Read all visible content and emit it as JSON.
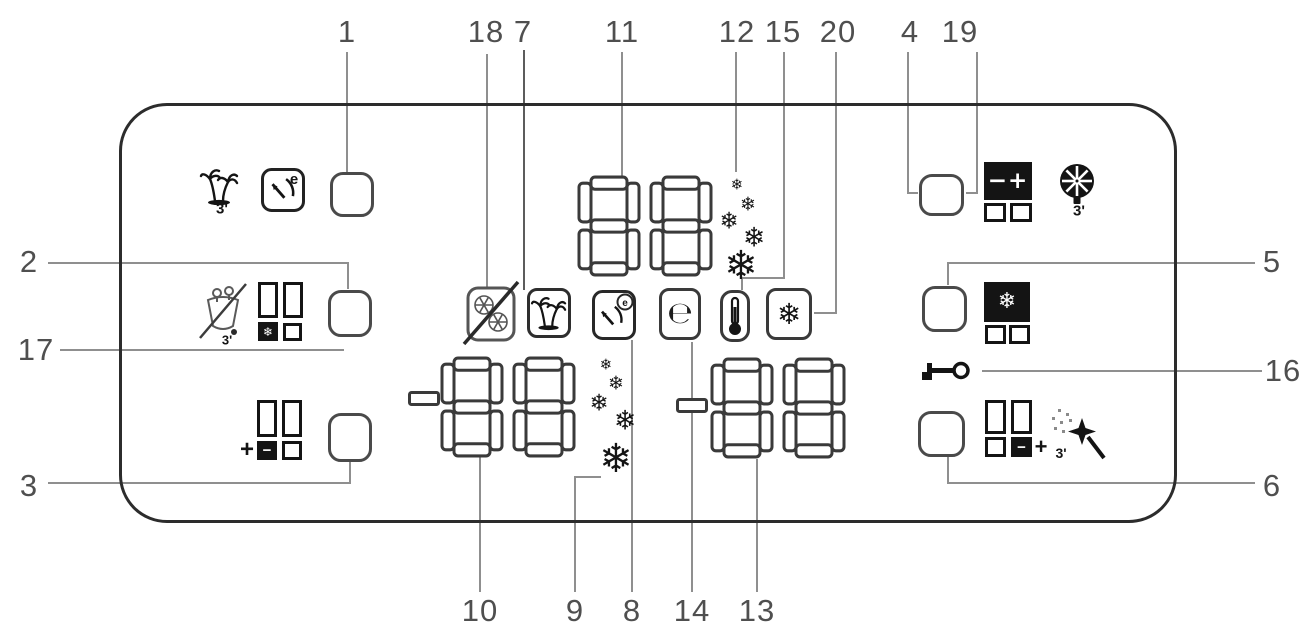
{
  "diagram": {
    "type": "appliance-control-panel-callout-diagram",
    "colors": {
      "background": "#ffffff",
      "panel_border": "#2c2c2c",
      "leader_line": "#8f8f8f",
      "number": "#4f4f4f",
      "icon": "#141414"
    },
    "callouts": {
      "c1": "1",
      "c2": "2",
      "c3": "3",
      "c4": "4",
      "c5": "5",
      "c6": "6",
      "c7": "7",
      "c8": "8",
      "c9": "9",
      "c10": "10",
      "c11": "11",
      "c12": "12",
      "c13": "13",
      "c14": "14",
      "c15": "15",
      "c16": "16",
      "c17": "17",
      "c18": "18",
      "c19": "19",
      "c20": "20"
    },
    "displays": {
      "main": {
        "value": "88"
      },
      "left": {
        "value": "-88"
      },
      "right": {
        "value": "-88"
      }
    },
    "glyphs": {
      "snowflake": "❄",
      "minus": "−",
      "plus": "+",
      "minus_plus": "−+",
      "e_letter": "e",
      "e_symbol": "℮",
      "three_marker": "3'"
    },
    "icons": [
      "holiday-palm-icon",
      "eco-gauge-icon",
      "bottle-cool-off-icon",
      "grid-snowflake-icon",
      "grid-minus-icon",
      "seven-segment-display",
      "snowflake-scale-icon",
      "no-frost-off-box-icon",
      "holiday-box-icon",
      "eco-gauge-box-icon",
      "e-mode-box-icon",
      "thermometer-box-icon",
      "snowflake-box-icon",
      "fan-wheel-icon",
      "grid-minus-plus-icon",
      "grid-freeze-icon",
      "key-lock-icon",
      "grid-superfreeze-icon",
      "magic-wand-icon"
    ]
  }
}
